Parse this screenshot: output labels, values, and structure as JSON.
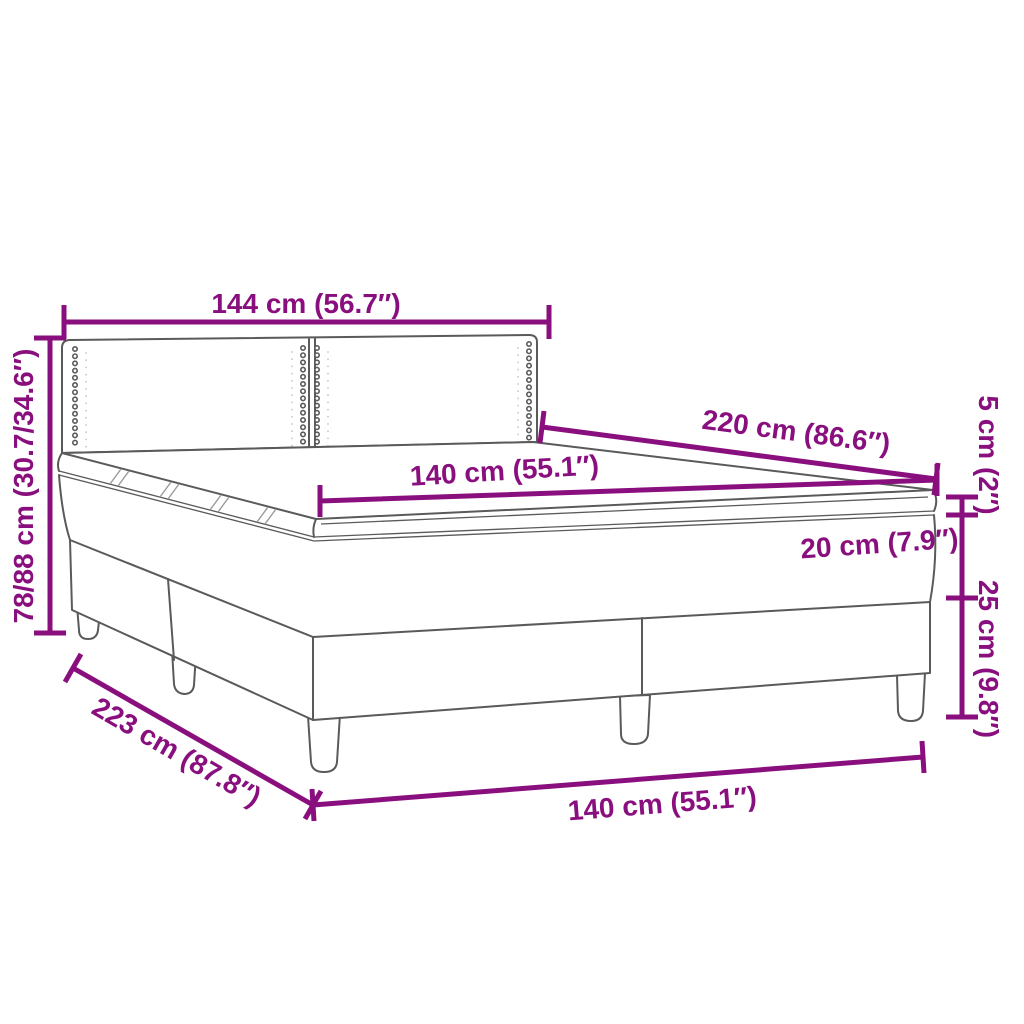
{
  "diagram": {
    "accent_color": "#8A0F7E",
    "line_color": "#5A5A5A",
    "background_color": "#FFFFFF",
    "labels": {
      "headboard_width": "144 cm (56.7″)",
      "total_height": "78/88 cm (30.7/34.6″)",
      "length_top": "220 cm (86.6″)",
      "mattress_width": "140 cm (55.1″)",
      "topper_height": "5 cm (2″)",
      "mattress_height": "20 cm (7.9″)",
      "base_height": "25 cm (9.8″)",
      "length_side": "223 cm (87.8″)",
      "width_front": "140 cm (55.1″)"
    }
  }
}
